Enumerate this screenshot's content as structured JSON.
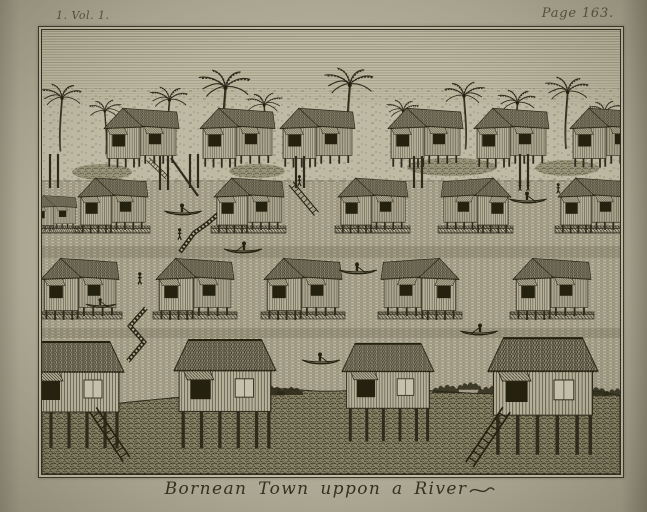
{
  "page": {
    "vol_label": "1. Vol. 1.",
    "page_label": "Page 163.",
    "caption": "Bornean Town uppon a River"
  },
  "colors": {
    "paper": "#afab96",
    "plate_bg": "#bfbaa3",
    "ink": "#332e20"
  },
  "scene": {
    "mid": [
      {
        "t": "palm",
        "x": -4,
        "y": 54,
        "s": 0.75
      },
      {
        "t": "palm",
        "x": 46,
        "y": 70,
        "s": 0.6,
        "f": -1
      },
      {
        "t": "palm",
        "x": 105,
        "y": 57,
        "s": 0.7
      },
      {
        "t": "palm",
        "x": 153,
        "y": 40,
        "s": 0.95
      },
      {
        "t": "palm",
        "x": 204,
        "y": 63,
        "s": 0.65,
        "f": -1
      },
      {
        "t": "palm",
        "x": 279,
        "y": 38,
        "s": 0.9
      },
      {
        "t": "palm",
        "x": 342,
        "y": 70,
        "s": 0.6
      },
      {
        "t": "palm",
        "x": 401,
        "y": 52,
        "s": 0.75,
        "f": -1
      },
      {
        "t": "palm",
        "x": 453,
        "y": 60,
        "s": 0.7
      },
      {
        "t": "palm",
        "x": 500,
        "y": 47,
        "s": 0.8
      },
      {
        "t": "palm",
        "x": 546,
        "y": 71,
        "s": 0.6,
        "f": -1
      },
      {
        "t": "scrub",
        "cx": 60,
        "cy": 142,
        "rx": 30,
        "ry": 8
      },
      {
        "t": "scrub",
        "cx": 215,
        "cy": 141,
        "rx": 28,
        "ry": 7
      },
      {
        "t": "scrub",
        "cx": 410,
        "cy": 137,
        "rx": 45,
        "ry": 9
      },
      {
        "t": "scrub",
        "cx": 525,
        "cy": 138,
        "rx": 32,
        "ry": 8
      },
      {
        "t": "house",
        "x": 62,
        "y": 76,
        "s": 0.75
      },
      {
        "t": "house",
        "x": 158,
        "y": 76,
        "s": 0.75
      },
      {
        "t": "house",
        "x": 238,
        "y": 76,
        "s": 0.75
      },
      {
        "t": "house",
        "x": 346,
        "y": 76,
        "s": 0.75
      },
      {
        "t": "house",
        "x": 432,
        "y": 76,
        "s": 0.75
      },
      {
        "t": "house",
        "x": 528,
        "y": 76,
        "s": 0.75
      },
      {
        "t": "post",
        "x1": 8,
        "y1": 124,
        "x2": 8,
        "y2": 158
      },
      {
        "t": "post",
        "x1": 16,
        "y1": 124,
        "x2": 16,
        "y2": 158
      },
      {
        "t": "post",
        "x1": 118,
        "y1": 126,
        "x2": 118,
        "y2": 160
      },
      {
        "t": "post",
        "x1": 126,
        "y1": 126,
        "x2": 126,
        "y2": 160
      },
      {
        "t": "post",
        "x1": 148,
        "y1": 124,
        "x2": 148,
        "y2": 158
      },
      {
        "t": "post",
        "x1": 156,
        "y1": 124,
        "x2": 156,
        "y2": 158
      },
      {
        "t": "post",
        "x1": 254,
        "y1": 126,
        "x2": 254,
        "y2": 158
      },
      {
        "t": "post",
        "x1": 262,
        "y1": 126,
        "x2": 262,
        "y2": 158
      },
      {
        "t": "post",
        "x1": 372,
        "y1": 126,
        "x2": 372,
        "y2": 158
      },
      {
        "t": "post",
        "x1": 380,
        "y1": 126,
        "x2": 380,
        "y2": 158
      },
      {
        "t": "post",
        "x1": 478,
        "y1": 124,
        "x2": 478,
        "y2": 158
      },
      {
        "t": "post",
        "x1": 486,
        "y1": 124,
        "x2": 486,
        "y2": 158
      },
      {
        "t": "post",
        "x1": 129,
        "y1": 128,
        "x2": 156,
        "y2": 166
      },
      {
        "t": "ladder",
        "x": 104,
        "y": 131,
        "r": -46,
        "s": 0.45
      },
      {
        "t": "walk",
        "d": "M186,175 L166,193 L152,203 L138,222"
      },
      {
        "t": "platform",
        "x": -9,
        "y": 196,
        "sx": 0.5
      },
      {
        "t": "platform",
        "x": 33,
        "y": 196,
        "sx": 0.75
      },
      {
        "t": "platform",
        "x": 169,
        "y": 196,
        "sx": 0.75
      },
      {
        "t": "platform",
        "x": 293,
        "y": 196,
        "sx": 0.75
      },
      {
        "t": "platform",
        "x": 396,
        "y": 196,
        "sx": 0.75
      },
      {
        "t": "platform",
        "x": 513,
        "y": 196,
        "sx": 0.75
      },
      {
        "t": "house",
        "x": -10,
        "y": 164,
        "s": 0.45
      },
      {
        "t": "house",
        "x": 36,
        "y": 146,
        "s": 0.7
      },
      {
        "t": "house",
        "x": 172,
        "y": 146,
        "s": 0.7
      },
      {
        "t": "house",
        "x": 296,
        "y": 146,
        "s": 0.7
      },
      {
        "t": "house",
        "x": 399,
        "y": 146,
        "s": 0.7,
        "f": -1
      },
      {
        "t": "house",
        "x": 516,
        "y": 146,
        "s": 0.7
      },
      {
        "t": "ladder",
        "x": 246,
        "y": 156,
        "r": -40,
        "s": 0.66
      },
      {
        "t": "person",
        "x": 254,
        "y": 145,
        "s": 0.85
      },
      {
        "t": "canoe",
        "x": 121,
        "y": 172,
        "s": 1
      },
      {
        "t": "canoe",
        "x": 181,
        "y": 210,
        "s": 1,
        "f": -1
      },
      {
        "t": "canoe",
        "x": 466,
        "y": 160,
        "s": 1
      },
      {
        "t": "person",
        "x": 475,
        "y": 151,
        "s": 0.75
      },
      {
        "t": "person",
        "x": 483,
        "y": 151,
        "s": 0.75
      },
      {
        "t": "person",
        "x": 513,
        "y": 153,
        "s": 0.8
      },
      {
        "t": "person",
        "x": 134,
        "y": 198,
        "s": 0.9
      },
      {
        "t": "platform",
        "x": -4,
        "y": 282,
        "sx": 0.84
      },
      {
        "t": "platform",
        "x": 111,
        "y": 282,
        "sx": 0.84
      },
      {
        "t": "platform",
        "x": 219,
        "y": 282,
        "sx": 0.84
      },
      {
        "t": "platform",
        "x": 336,
        "y": 282,
        "sx": 0.84
      },
      {
        "t": "platform",
        "x": 468,
        "y": 282,
        "sx": 0.84
      },
      {
        "t": "house",
        "x": -1,
        "y": 226,
        "s": 0.78
      },
      {
        "t": "house",
        "x": 114,
        "y": 226,
        "s": 0.78
      },
      {
        "t": "house",
        "x": 222,
        "y": 226,
        "s": 0.78
      },
      {
        "t": "house",
        "x": 339,
        "y": 226,
        "s": 0.78,
        "f": -1
      },
      {
        "t": "house",
        "x": 471,
        "y": 226,
        "s": 0.78
      },
      {
        "t": "walk",
        "d": "M104,278 L88,296 L102,312 L86,331"
      },
      {
        "t": "person",
        "x": 94,
        "y": 242,
        "s": 0.95
      },
      {
        "t": "canoe",
        "x": 296,
        "y": 231,
        "s": 1
      },
      {
        "t": "canoe",
        "x": 417,
        "y": 292,
        "s": 1,
        "f": -1
      },
      {
        "t": "canoe",
        "x": 259,
        "y": 321,
        "s": 1
      },
      {
        "t": "canoe",
        "x": 43,
        "y": 267,
        "s": 0.8
      }
    ],
    "fg": [
      {
        "t": "bush",
        "x": 8,
        "y": 364,
        "s": 0.8
      },
      {
        "t": "bush",
        "x": 45,
        "y": 360,
        "s": 1
      },
      {
        "t": "bush",
        "x": 135,
        "y": 357,
        "s": 0.9
      },
      {
        "t": "bush",
        "x": 168,
        "y": 352,
        "s": 1.1
      },
      {
        "t": "bush",
        "x": 190,
        "y": 349,
        "s": 1
      },
      {
        "t": "bush",
        "x": 208,
        "y": 351,
        "s": 1.2
      },
      {
        "t": "bush",
        "x": 232,
        "y": 353,
        "s": 1
      },
      {
        "t": "bush",
        "x": 303,
        "y": 349,
        "s": 1.1
      },
      {
        "t": "bush",
        "x": 388,
        "y": 351,
        "s": 1
      },
      {
        "t": "bush",
        "x": 413,
        "y": 349,
        "s": 0.9
      },
      {
        "t": "bush",
        "x": 433,
        "y": 352,
        "s": 1
      },
      {
        "t": "bush",
        "x": 535,
        "y": 353,
        "s": 1.1
      },
      {
        "t": "bush",
        "x": 560,
        "y": 355,
        "s": 0.9
      },
      {
        "t": "tall",
        "x": -18,
        "y": 310,
        "s": 1.0
      },
      {
        "t": "tall",
        "x": 132,
        "y": 308,
        "s": 1.02
      },
      {
        "t": "tall",
        "x": 300,
        "y": 312,
        "s": 0.92
      },
      {
        "t": "tall",
        "x": 446,
        "y": 306,
        "s": 1.1
      },
      {
        "t": "ladder",
        "x": 46,
        "y": 383,
        "r": -34,
        "s": 1.0
      },
      {
        "t": "ladder",
        "x": 459,
        "y": 376,
        "r": 34,
        "s": 1.1
      }
    ]
  }
}
